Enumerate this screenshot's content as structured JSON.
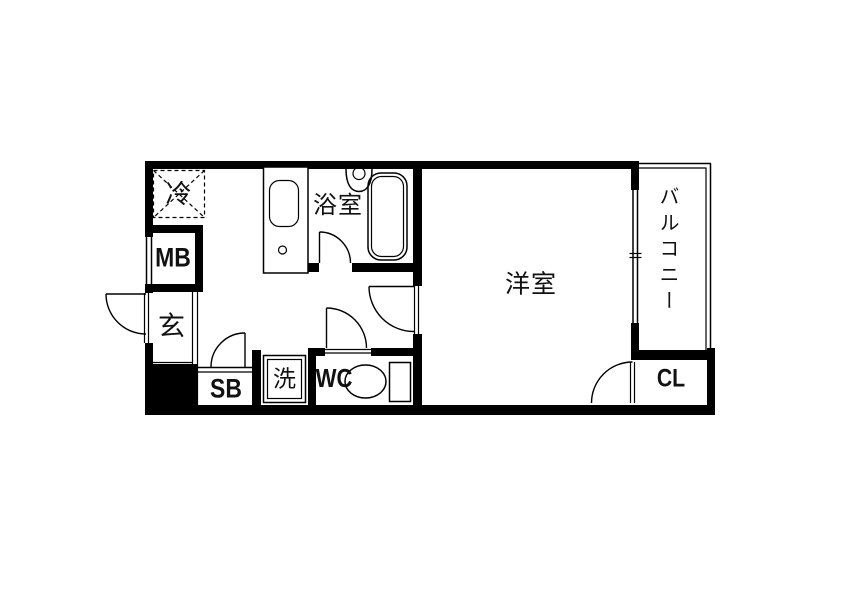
{
  "floor_plan": {
    "type": "japanese-apartment-floorplan-1K",
    "colors": {
      "background": "#ffffff",
      "line": "#000000",
      "text": "#111111"
    },
    "labels": {
      "refrigerator": "冷",
      "meter_box": "MB",
      "entrance": "玄",
      "shoe_box": "SB",
      "laundry": "洗",
      "wc": "WC",
      "bathroom": "浴室",
      "western_room": "洋室",
      "balcony": "バルコニー",
      "closet": "CL"
    }
  }
}
